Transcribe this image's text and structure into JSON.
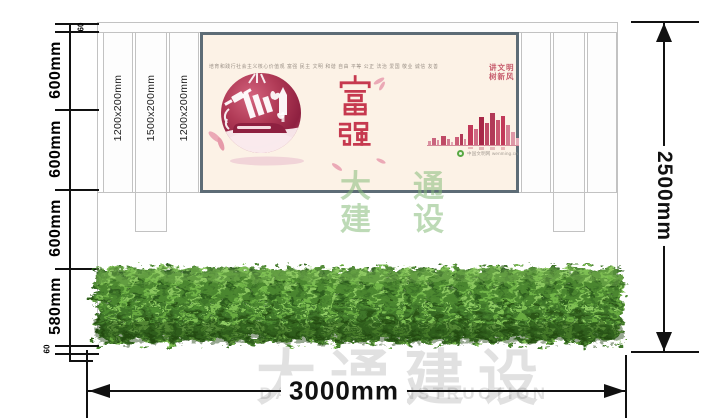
{
  "dimensions": {
    "left_segments": [
      "60",
      "600mm",
      "600mm",
      "600mm",
      "580mm",
      "60"
    ],
    "right_total": "2500mm",
    "bottom_total": "3000mm"
  },
  "panels": {
    "labels": [
      "1200x200mm",
      "1500x200mm",
      "1200x200mm"
    ]
  },
  "poster": {
    "core_values_line": "培育和践行社会主义核心价值观  富强 民主 文明 和谐 自由 平等 公正 法治 爱国 敬业 诚信 友善",
    "main_characters": "富强",
    "slogan": {
      "line1": "讲文明",
      "line2": "树新风"
    },
    "caption": "中国文明网 wenming.cn"
  },
  "watermarks": {
    "center_green": {
      "row1": "大通",
      "row2": "建设"
    },
    "bottom_gray": {
      "cn": "大通建设",
      "en": "DA TONG CONSTRUCTION"
    }
  },
  "colors": {
    "poster_red": "#c6394f",
    "poster_bg": "#fcf2e6",
    "hedge_green": "#41772a",
    "watermark_green": "#86bc7a"
  }
}
